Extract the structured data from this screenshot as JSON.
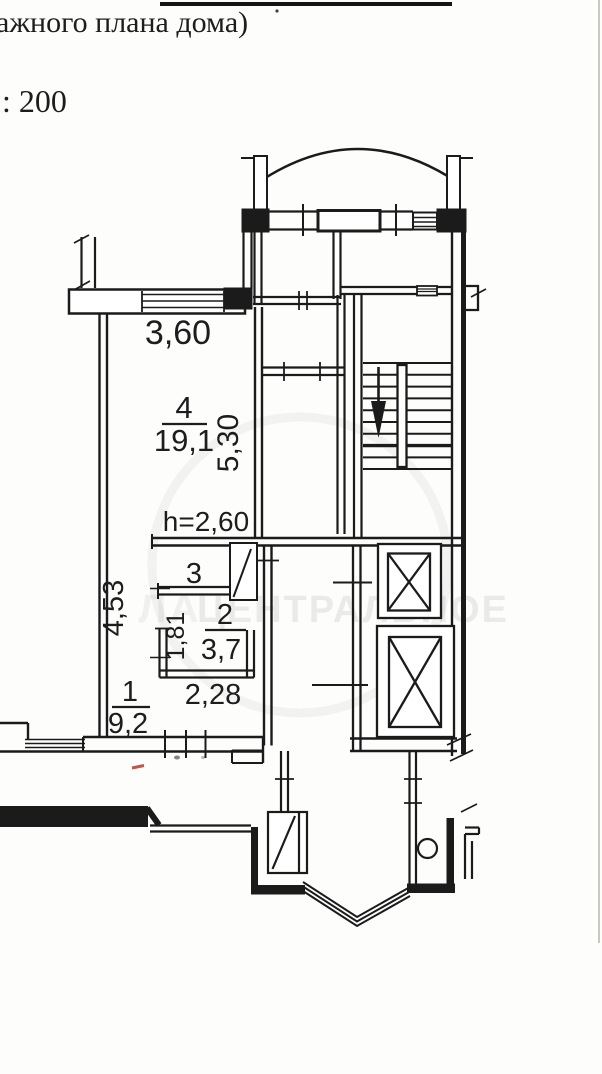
{
  "document": {
    "top_text_fragment": "ажного плана дома)",
    "scale_text": ": 200"
  },
  "watermark": {
    "left_fragment": "ЛА",
    "agency_text": "ЦЕНТРАЛЬНОЕ"
  },
  "plan": {
    "room4": {
      "number": "4",
      "area": "19,1"
    },
    "room3": {
      "number": "3"
    },
    "room2": {
      "number": "2",
      "area": "3,7"
    },
    "room1": {
      "number": "1",
      "area": "9,2"
    },
    "dims": {
      "room4_width": "3,60",
      "room4_depth": "5,30",
      "ceiling_height": "h=2,60",
      "hall_length": "4,53",
      "bath_width": "1,81",
      "bath_length": "2,28"
    }
  }
}
